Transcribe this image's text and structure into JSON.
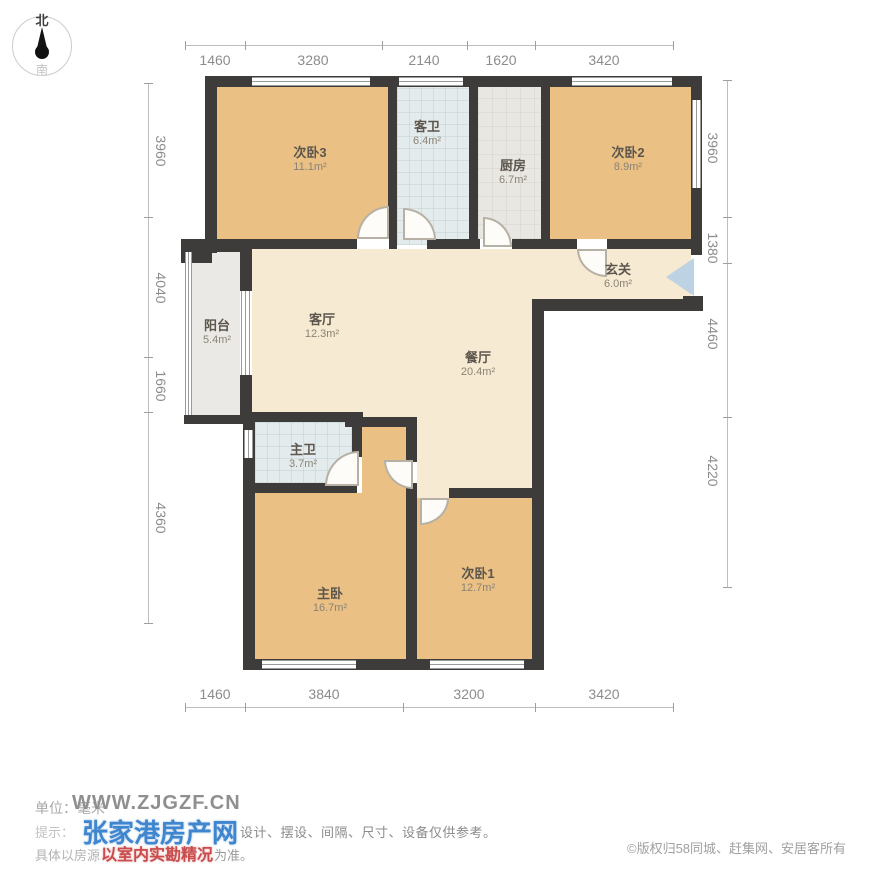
{
  "compass": {
    "north": "北",
    "south": "南"
  },
  "dimensions": {
    "top": [
      "1460",
      "3280",
      "2140",
      "1620",
      "3420"
    ],
    "bottom": [
      "1460",
      "3840",
      "3200",
      "3420"
    ],
    "left": [
      "3960",
      "4040",
      "1660",
      "4360"
    ],
    "right": [
      "3960",
      "1380",
      "4460",
      "4220"
    ]
  },
  "rooms": {
    "bedroom3": {
      "name": "次卧3",
      "area": "11.1m²"
    },
    "guest_bath": {
      "name": "客卫",
      "area": "6.4m²"
    },
    "kitchen": {
      "name": "厨房",
      "area": "6.7m²"
    },
    "bedroom2": {
      "name": "次卧2",
      "area": "8.9m²"
    },
    "entry": {
      "name": "玄关",
      "area": "6.0m²"
    },
    "balcony": {
      "name": "阳台",
      "area": "5.4m²"
    },
    "living": {
      "name": "客厅",
      "area": "12.3m²"
    },
    "dining": {
      "name": "餐厅",
      "area": "20.4m²"
    },
    "master_bath": {
      "name": "主卫",
      "area": "3.7m²"
    },
    "master": {
      "name": "主卧",
      "area": "16.7m²"
    },
    "bedroom1": {
      "name": "次卧1",
      "area": "12.7m²"
    }
  },
  "footer": {
    "unit_label": "单位：毫米",
    "watermark_site": "WWW.ZJGZF.CN",
    "tip_prefix": "提示：",
    "watermark_brand": "张家港房产网",
    "disclaimer": "设计、摆设、间隔、尺寸、设备仅供参考。",
    "line3_prefix": "具体以房源",
    "watermark_red": "以室内实勘精况",
    "line3_suffix": "为准。",
    "copyright": "©版权归58同城、赶集网、安居客所有"
  },
  "colors": {
    "wall": "#3e3c3a",
    "bedroom_floor": "#eac084",
    "hall_floor": "#f6ead2",
    "bath_floor": "#e4ebec",
    "kitchen_floor": "#e9e7e2",
    "balcony_floor": "#ebe9e5",
    "entry_arrow": "#bdd2e3",
    "watermark_blue": "#3f86cf",
    "watermark_red": "#c94b4b"
  }
}
